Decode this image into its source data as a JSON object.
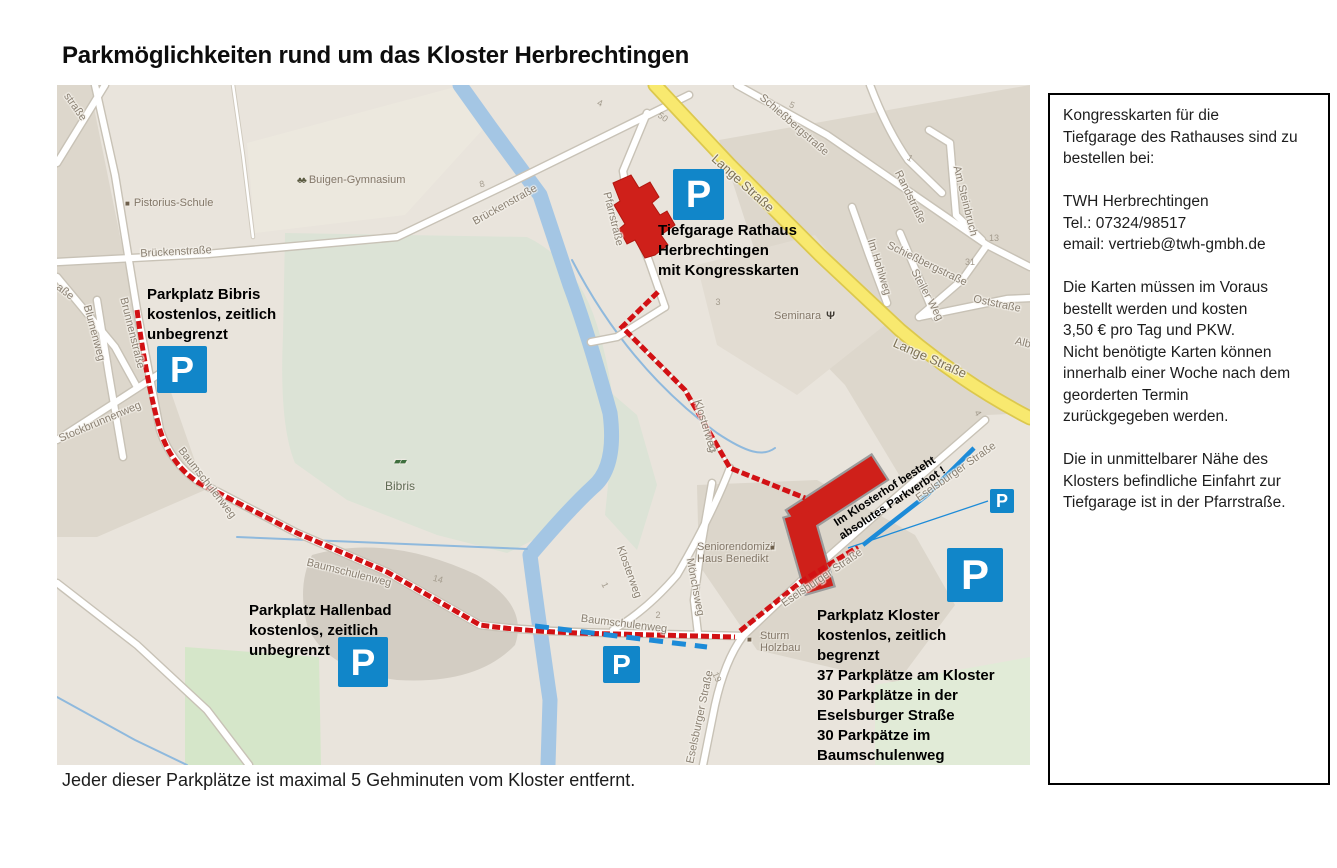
{
  "title": "Parkmöglichkeiten rund um das Kloster Herbrechtingen",
  "footer": "Jeder dieser Parkplätze ist maximal 5 Gehminuten vom Kloster entfernt.",
  "info_box": {
    "text": "Kongresskarten für die\nTiefgarage des Rathauses sind zu\nbestellen bei:\n\nTWH Herbrechtingen\nTel.: 07324/98517\nemail: vertrieb@twh-gmbh.de\n\nDie Karten müssen im Voraus\nbestellt werden und kosten\n3,50 € pro Tag und PKW.\nNicht benötigte Karten können\ninnerhalb einer Woche nach dem\ngeorderten Termin\nzurückgegeben werden.\n\nDie in unmittelbarer Nähe des\nKlosters befindliche Einfahrt zur\nTiefgarage ist in der Pfarrstraße."
  },
  "map": {
    "p_letter": "P",
    "annotations": {
      "bibris": "Parkplatz Bibris\nkostenlos, zeitlich\nunbegrenzt",
      "tiefgarage": "Tiefgarage Rathaus\nHerbrechtingen\nmit Kongresskarten",
      "hallenbad": "Parkplatz Hallenbad\nkostenlos, zeitlich\nunbegrenzt",
      "kloster": "Parkplatz Kloster\nkostenlos, zeitlich      begrenzt\n37 Parkplätze am Kloster\n30 Parkplätze in der\nEselsburger Straße\n30 Parkpätze im\nBaumschulenweg",
      "parkverbot": "Im Klosterhof besteht\nabsolutes Parkverbot !"
    },
    "streets": {
      "brueckenstrasse": "Brückenstraße",
      "brunnenstrasse": "Brunnenstraße",
      "strasse_fragment": "straße",
      "asse_fragment": "aße",
      "blumenweg": "Blumenweg",
      "stockbrunnenweg": "Stockbrunnenweg",
      "baumschulenweg": "Baumschulenweg",
      "pfarrstrasse": "Pfarrstraße",
      "lange_strasse": "Lange Straße",
      "schiessbergstrasse": "Schießbergstraße",
      "randstrasse": "Randstraße",
      "am_steinbruch": "Am Steinbruch",
      "steiler_weg": "Steiler Weg",
      "oststrasse": "Oststraße",
      "im_hohlweg": "Im Hohlweg",
      "klosterweg": "Klosterweg",
      "moenchsweg": "Mönchsweg",
      "eselsburger_strasse": "Eselsburger Straße",
      "alb_fragment": "Alb"
    },
    "pois": {
      "pistorius_schule": "Pistorius-Schule",
      "buigen_gymnasium": "Buigen-Gymnasium",
      "bibris": "Bibris",
      "seminara": "Seminara",
      "seniorendomizil": "Seniorendomizil\nHaus Benedikt",
      "sturm_holzbau": "Sturm\nHolzbau"
    },
    "numbers": {
      "n4a": "4",
      "n50": "50",
      "n5": "5",
      "n1a": "1",
      "n13a": "13",
      "n31": "31",
      "n8": "8",
      "n3": "3",
      "n4b": "4",
      "n1b": "1",
      "n2": "2",
      "n13b": "13",
      "n14": "14",
      "n19": "19"
    },
    "icons": {
      "square_marker": "■",
      "trees_icon": "♣♣",
      "bibris_icon": "▰▰",
      "restaurant_icon": "Ψ"
    }
  },
  "colors": {
    "parking_blue": "#1186c9",
    "route_red": "#d21114",
    "route_blue": "#1d8bd8",
    "building_red": "#cf201a",
    "road_yellow": "#f8e96f"
  }
}
